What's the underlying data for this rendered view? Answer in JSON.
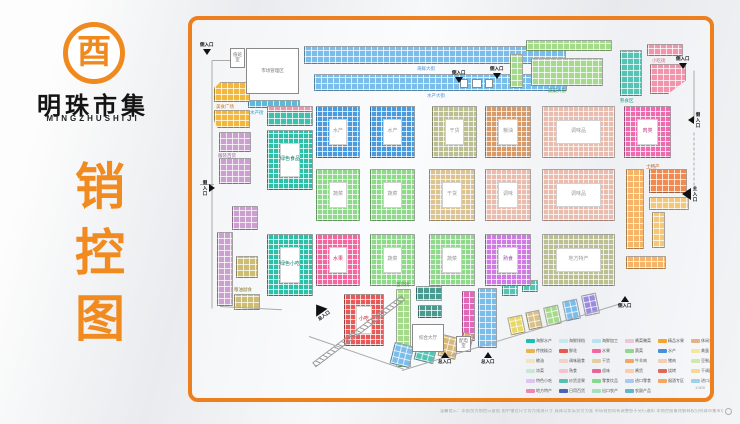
{
  "branding": {
    "logo_glyph": "酉",
    "name": "明珠市集",
    "name_en": "MINGZHUSHIJI",
    "vertical_title": "销控图"
  },
  "map": {
    "blocks": [
      {
        "k": "cells",
        "x": 112,
        "y": 26,
        "w": 262,
        "h": 18,
        "c": "#7bbdea"
      },
      {
        "k": "cells",
        "x": 122,
        "y": 54,
        "w": 253,
        "h": 17,
        "c": "#7bbdea"
      },
      {
        "k": "cells",
        "x": 56,
        "y": 80,
        "w": 52,
        "h": 8,
        "c": "#5fb8d8"
      },
      {
        "k": "cells",
        "x": 334,
        "y": 20,
        "w": 86,
        "h": 11,
        "c": "#a5d98c"
      },
      {
        "k": "cells",
        "x": 339,
        "y": 38,
        "w": 72,
        "h": 28,
        "c": "#a5d98c"
      },
      {
        "k": "cells",
        "x": 318,
        "y": 34,
        "w": 13,
        "h": 34,
        "c": "#a5d98c"
      },
      {
        "k": "cells",
        "x": 428,
        "y": 30,
        "w": 22,
        "h": 46,
        "c": "#55c4b4"
      },
      {
        "k": "cells",
        "x": 455,
        "y": 24,
        "w": 36,
        "h": 12,
        "c": "#f295ac"
      },
      {
        "k": "cells",
        "x": 458,
        "y": 44,
        "w": 36,
        "h": 30,
        "c": "#f295ac",
        "cp": "polygon(0 0,100% 0,100% 55%,50% 100%,0 100%)"
      },
      {
        "k": "cells",
        "x": 22,
        "y": 62,
        "w": 36,
        "h": 20,
        "c": "#f2b83e",
        "cp": "polygon(18% 0,100% 0,100% 100%,0 100%,0 30%)"
      },
      {
        "k": "cells",
        "x": 22,
        "y": 90,
        "w": 36,
        "h": 18,
        "c": "#f2b83e",
        "cp": "polygon(0 0,100% 0,100% 100%,10% 100%,0 60%)"
      },
      {
        "k": "cells",
        "x": 27,
        "y": 112,
        "w": 32,
        "h": 20,
        "c": "#cb9fd0"
      },
      {
        "k": "cells",
        "x": 27,
        "y": 138,
        "w": 32,
        "h": 26,
        "c": "#cb9fd0"
      },
      {
        "k": "cells",
        "x": 40,
        "y": 186,
        "w": 26,
        "h": 24,
        "c": "#cb9fd0"
      },
      {
        "k": "cells",
        "x": 25,
        "y": 212,
        "w": 16,
        "h": 74,
        "c": "#cb9fd0"
      },
      {
        "k": "cells",
        "x": 44,
        "y": 236,
        "w": 22,
        "h": 22,
        "c": "#cdbd74"
      },
      {
        "k": "cells",
        "x": 42,
        "y": 274,
        "w": 26,
        "h": 16,
        "c": "#cdbd74"
      },
      {
        "k": "cells",
        "x": 434,
        "y": 149,
        "w": 18,
        "h": 80,
        "c": "#f5b468"
      },
      {
        "k": "cells",
        "x": 457,
        "y": 149,
        "w": 38,
        "h": 24,
        "c": "#f08a50"
      },
      {
        "k": "cells",
        "x": 457,
        "y": 177,
        "w": 40,
        "h": 13,
        "c": "#f5c878"
      },
      {
        "k": "cells",
        "x": 460,
        "y": 192,
        "w": 13,
        "h": 36,
        "c": "#f5c878"
      },
      {
        "k": "cells",
        "x": 434,
        "y": 236,
        "w": 40,
        "h": 13,
        "c": "#f5b468"
      },
      {
        "k": "cells",
        "x": 204,
        "y": 269,
        "w": 15,
        "h": 78,
        "c": "#a5d98c"
      },
      {
        "k": "cells",
        "x": 224,
        "y": 266,
        "w": 26,
        "h": 15,
        "c": "#4a9a92"
      },
      {
        "k": "cells",
        "x": 226,
        "y": 285,
        "w": 24,
        "h": 13,
        "c": "#4a9a92"
      },
      {
        "k": "cells",
        "x": 270,
        "y": 271,
        "w": 13,
        "h": 50,
        "c": "#e06ab8"
      },
      {
        "k": "cells",
        "x": 286,
        "y": 268,
        "w": 19,
        "h": 60,
        "c": "#7bbdea"
      },
      {
        "k": "cells",
        "x": 310,
        "y": 264,
        "w": 16,
        "h": 12,
        "c": "#55c4b4"
      },
      {
        "k": "cells",
        "x": 330,
        "y": 260,
        "w": 16,
        "h": 12,
        "c": "#55c4b4"
      },
      {
        "k": "cells",
        "x": 317,
        "y": 296,
        "w": 15,
        "h": 18,
        "c": "#e8d868",
        "r": -12
      },
      {
        "k": "cells",
        "x": 335,
        "y": 291,
        "w": 14,
        "h": 18,
        "c": "#d8c088",
        "r": -12
      },
      {
        "k": "cells",
        "x": 353,
        "y": 286,
        "w": 15,
        "h": 19,
        "c": "#a5d98c",
        "r": -12
      },
      {
        "k": "cells",
        "x": 372,
        "y": 280,
        "w": 15,
        "h": 20,
        "c": "#7bbdea",
        "r": -12
      },
      {
        "k": "cells",
        "x": 391,
        "y": 274,
        "w": 15,
        "h": 21,
        "c": "#9a8ae0",
        "r": -12
      },
      {
        "k": "cells",
        "x": 200,
        "y": 324,
        "w": 20,
        "h": 22,
        "c": "#7bbdea",
        "r": 14
      },
      {
        "k": "cells",
        "x": 224,
        "y": 320,
        "w": 20,
        "h": 22,
        "c": "#55c4b4",
        "r": 14
      },
      {
        "k": "cells",
        "x": 248,
        "y": 316,
        "w": 18,
        "h": 22,
        "c": "#d8b878",
        "r": 14
      },
      {
        "k": "cells",
        "x": 269,
        "y": 313,
        "w": 11,
        "h": 18,
        "c": "#f0a868",
        "r": 14
      },
      {
        "k": "cells",
        "x": 75,
        "y": 86,
        "w": 46,
        "h": 20,
        "c": "#3fbfae"
      },
      {
        "k": "cells",
        "x": 75,
        "y": 86,
        "w": 46,
        "h": 6,
        "c": "#f295ac"
      },
      {
        "k": "ring",
        "x": 75,
        "y": 110,
        "w": 46,
        "h": 60,
        "c": "#2fbfa8",
        "th": 12,
        "lb": "绿色食品",
        "lc": "#0a7a68"
      },
      {
        "k": "ring",
        "x": 75,
        "y": 214,
        "w": 46,
        "h": 62,
        "c": "#2fbfa8",
        "th": 12,
        "lb": "绿色小吃",
        "lc": "#0a7a68"
      },
      {
        "k": "ring",
        "x": 124,
        "y": 86,
        "w": 44,
        "h": 52,
        "c": "#4a9ae0",
        "th": 12,
        "lb": "水产"
      },
      {
        "k": "ring",
        "x": 178,
        "y": 86,
        "w": 45,
        "h": 52,
        "c": "#4a9ae0",
        "th": 12,
        "lb": "水产"
      },
      {
        "k": "ring",
        "x": 240,
        "y": 86,
        "w": 45,
        "h": 52,
        "c": "#bcbf92",
        "th": 12,
        "lb": "干货"
      },
      {
        "k": "ring",
        "x": 293,
        "y": 86,
        "w": 46,
        "h": 52,
        "c": "#d99a6a",
        "th": 12,
        "lb": "粮油"
      },
      {
        "k": "ring",
        "x": 350,
        "y": 86,
        "w": 73,
        "h": 52,
        "c": "#eabcae",
        "th": 13,
        "lb": "调味品"
      },
      {
        "k": "ring",
        "x": 432,
        "y": 86,
        "w": 47,
        "h": 52,
        "c": "#ef6aae",
        "th": 12,
        "lb": "肉类",
        "lc": "#c03a7e"
      },
      {
        "k": "ring",
        "x": 124,
        "y": 149,
        "w": 44,
        "h": 52,
        "c": "#8fd98a",
        "th": 12,
        "lb": "蔬菜"
      },
      {
        "k": "ring",
        "x": 178,
        "y": 149,
        "w": 45,
        "h": 52,
        "c": "#8fd98a",
        "th": 12,
        "lb": "蔬菜"
      },
      {
        "k": "ring",
        "x": 237,
        "y": 149,
        "w": 46,
        "h": 52,
        "c": "#dcc392",
        "th": 12,
        "lb": "干货"
      },
      {
        "k": "ring",
        "x": 293,
        "y": 149,
        "w": 46,
        "h": 52,
        "c": "#eabcae",
        "th": 12,
        "lb": "调味"
      },
      {
        "k": "ring",
        "x": 350,
        "y": 149,
        "w": 73,
        "h": 52,
        "c": "#eabcae",
        "th": 13,
        "lb": "调味品"
      },
      {
        "k": "ring",
        "x": 124,
        "y": 214,
        "w": 44,
        "h": 52,
        "c": "#f2679e",
        "th": 12,
        "lb": "水果",
        "lc": "#d03060"
      },
      {
        "k": "ring",
        "x": 178,
        "y": 214,
        "w": 45,
        "h": 52,
        "c": "#8fd98a",
        "th": 12,
        "lb": "蔬菜"
      },
      {
        "k": "ring",
        "x": 237,
        "y": 214,
        "w": 46,
        "h": 52,
        "c": "#8fd98a",
        "th": 12,
        "lb": "蔬菜"
      },
      {
        "k": "ring",
        "x": 293,
        "y": 214,
        "w": 46,
        "h": 52,
        "c": "#cf7ae5",
        "th": 12,
        "lb": "熟食",
        "lc": "#9a4ab5"
      },
      {
        "k": "ring",
        "x": 350,
        "y": 214,
        "w": 73,
        "h": 52,
        "c": "#bcbf92",
        "th": 13,
        "lb": "地方特产"
      },
      {
        "k": "ring",
        "x": 152,
        "y": 274,
        "w": 40,
        "h": 52,
        "c": "#e85a5a",
        "th": 11,
        "lb": "小吃",
        "lc": "#c02020"
      },
      {
        "k": "white",
        "x": 38,
        "y": 28,
        "w": 15,
        "h": 20,
        "lb": "值班室"
      },
      {
        "k": "white",
        "x": 54,
        "y": 28,
        "w": 53,
        "h": 46,
        "lb": "市场管理区"
      },
      {
        "k": "white",
        "x": 220,
        "y": 304,
        "w": 32,
        "h": 28,
        "lb": "综合大厅"
      },
      {
        "k": "white",
        "x": 264,
        "y": 316,
        "w": 15,
        "h": 16,
        "lb": "配电室"
      },
      {
        "k": "white",
        "x": 268,
        "y": 59,
        "w": 8,
        "h": 9
      },
      {
        "k": "white",
        "x": 280,
        "y": 59,
        "w": 10,
        "h": 9
      },
      {
        "k": "white",
        "x": 293,
        "y": 59,
        "w": 8,
        "h": 9
      },
      {
        "k": "hatch",
        "x": 122,
        "y": 342,
        "w": 112,
        "h": 6,
        "r": -37,
        "o": "left center"
      }
    ],
    "lines": [
      {
        "x": 20,
        "y": 40,
        "w": 18,
        "r": 0
      },
      {
        "x": 20,
        "y": 40,
        "w": 248,
        "r": 90
      },
      {
        "x": 8,
        "y": 164,
        "w": 14,
        "r": 0
      },
      {
        "x": 502,
        "y": 50,
        "w": 50,
        "r": 90
      },
      {
        "x": 502,
        "y": 112,
        "w": 58,
        "r": 90,
        "dash": true
      },
      {
        "x": 210,
        "y": 350,
        "w": 228,
        "r": -17
      },
      {
        "x": 117,
        "y": 316,
        "w": 100,
        "r": 19
      },
      {
        "x": 28,
        "y": 286,
        "w": 62,
        "r": 3
      }
    ],
    "area_labels": [
      {
        "x": 225,
        "y": 46,
        "t": "海鲜大街",
        "c": "#4a90d9"
      },
      {
        "x": 235,
        "y": 73,
        "t": "水产大街",
        "c": "#4a90d9"
      },
      {
        "x": 58,
        "y": 90,
        "t": "水产街",
        "c": "#2a9ac0"
      },
      {
        "x": 356,
        "y": 68,
        "t": "蔬菜大街",
        "c": "#4a9a3a"
      },
      {
        "x": 428,
        "y": 78,
        "t": "熟食区",
        "c": "#1a9a8a"
      },
      {
        "x": 460,
        "y": 38,
        "t": "小吃街",
        "c": "#d06080"
      },
      {
        "x": 24,
        "y": 84,
        "t": "美食广场",
        "c": "#c07818"
      },
      {
        "x": 26,
        "y": 133,
        "t": "服装百货",
        "c": "#9a5aa0"
      },
      {
        "x": 42,
        "y": 267,
        "t": "粮油副食",
        "c": "#8a7a30"
      },
      {
        "x": 454,
        "y": 144,
        "t": "土特产",
        "c": "#c05a20"
      },
      {
        "x": 204,
        "y": 262,
        "t": "百货街",
        "c": "#4a9a3a"
      }
    ],
    "entrances": [
      {
        "x": 8,
        "y": 22,
        "d": "down",
        "lb": "侧入口"
      },
      {
        "x": 260,
        "y": 50,
        "d": "down",
        "lb": "侧入口"
      },
      {
        "x": 298,
        "y": 46,
        "d": "down",
        "lb": "侧入口"
      },
      {
        "x": 484,
        "y": 36,
        "d": "down",
        "lb": "侧入口"
      },
      {
        "x": 496,
        "y": 92,
        "d": "left",
        "lb": "侧入口",
        "v": true
      },
      {
        "x": 490,
        "y": 166,
        "d": "left",
        "lb": "主入口",
        "v": true,
        "big": true
      },
      {
        "x": 10,
        "y": 160,
        "d": "right",
        "lb": "侧入口",
        "v": true
      },
      {
        "x": 122,
        "y": 283,
        "d": "up",
        "lb": "总入口",
        "big": true,
        "r": -35
      },
      {
        "x": 246,
        "y": 332,
        "d": "up",
        "lb": "总入口"
      },
      {
        "x": 289,
        "y": 332,
        "d": "up",
        "lb": "总入口"
      },
      {
        "x": 426,
        "y": 276,
        "d": "up",
        "lb": "侧入口"
      }
    ],
    "scale_note": {
      "x": 503,
      "y": 365,
      "t": "1:500"
    }
  },
  "legend": {
    "items": [
      {
        "c": "#1fbfae",
        "lb": "海鲜水产"
      },
      {
        "c": "#c2e9ec",
        "lb": "海鲜排档"
      },
      {
        "c": "#b9e2f0",
        "lb": "海鲜加工"
      },
      {
        "c": "#f0c6d6",
        "lb": "酱菜腌菜"
      },
      {
        "c": "#f5a62a",
        "lb": "精品水果"
      },
      {
        "c": "#e2b28c",
        "lb": "休闲食品"
      },
      {
        "c": "#eab44e",
        "lb": "传统糕点"
      },
      {
        "c": "#e8584a",
        "lb": "鲜花"
      },
      {
        "c": "#f2679e",
        "lb": "水果"
      },
      {
        "c": "#8fd98f",
        "lb": "蔬菜"
      },
      {
        "c": "#4a90d9",
        "lb": "水产"
      },
      {
        "c": "#f5e6a0",
        "lb": "禽蛋"
      },
      {
        "c": "#efe5c2",
        "lb": "粮油"
      },
      {
        "c": "#f0d2c8",
        "lb": "调味副食"
      },
      {
        "c": "#e2cfa0",
        "lb": "干货"
      },
      {
        "c": "#f0a868",
        "lb": "牛羊肉"
      },
      {
        "c": "#f5cdb5",
        "lb": "猪肉"
      },
      {
        "c": "#cfe8b0",
        "lb": "豆制品"
      },
      {
        "c": "#c5e8d8",
        "lb": "凉菜"
      },
      {
        "c": "#f5c3d0",
        "lb": "熟食"
      },
      {
        "c": "#e8639a",
        "lb": "卤味"
      },
      {
        "c": "#f7cfae",
        "lb": "酱货"
      },
      {
        "c": "#e06a55",
        "lb": "烧烤"
      },
      {
        "c": "#f5d898",
        "lb": "干调副食"
      },
      {
        "c": "#dec4f0",
        "lb": "特色小吃"
      },
      {
        "c": "#54c2b0",
        "lb": "炒货坚果"
      },
      {
        "c": "#83d98c",
        "lb": "零食饮品"
      },
      {
        "c": "#aac8f2",
        "lb": "进口零食"
      },
      {
        "c": "#f2a85e",
        "lb": "烟酒专区"
      },
      {
        "c": "#9fd2e8",
        "lb": "进口海鲜"
      },
      {
        "c": "#ef86b2",
        "lb": "地方特产"
      },
      {
        "c": "#4a63b5",
        "lb": "日用百货"
      },
      {
        "c": "#a5e0bc",
        "lb": "出口农产"
      },
      {
        "c": "#63b5c8",
        "lb": "农副产品"
      }
    ]
  },
  "footer": {
    "disclaimer": "温馨提示：本图仅为销控示意图  图中铺位尺寸均为预测尺寸  具体以实际交付为准  市场规划如有调整恕不另行通知  本销控图最终解释权归明珠市集市场管理方所有"
  }
}
